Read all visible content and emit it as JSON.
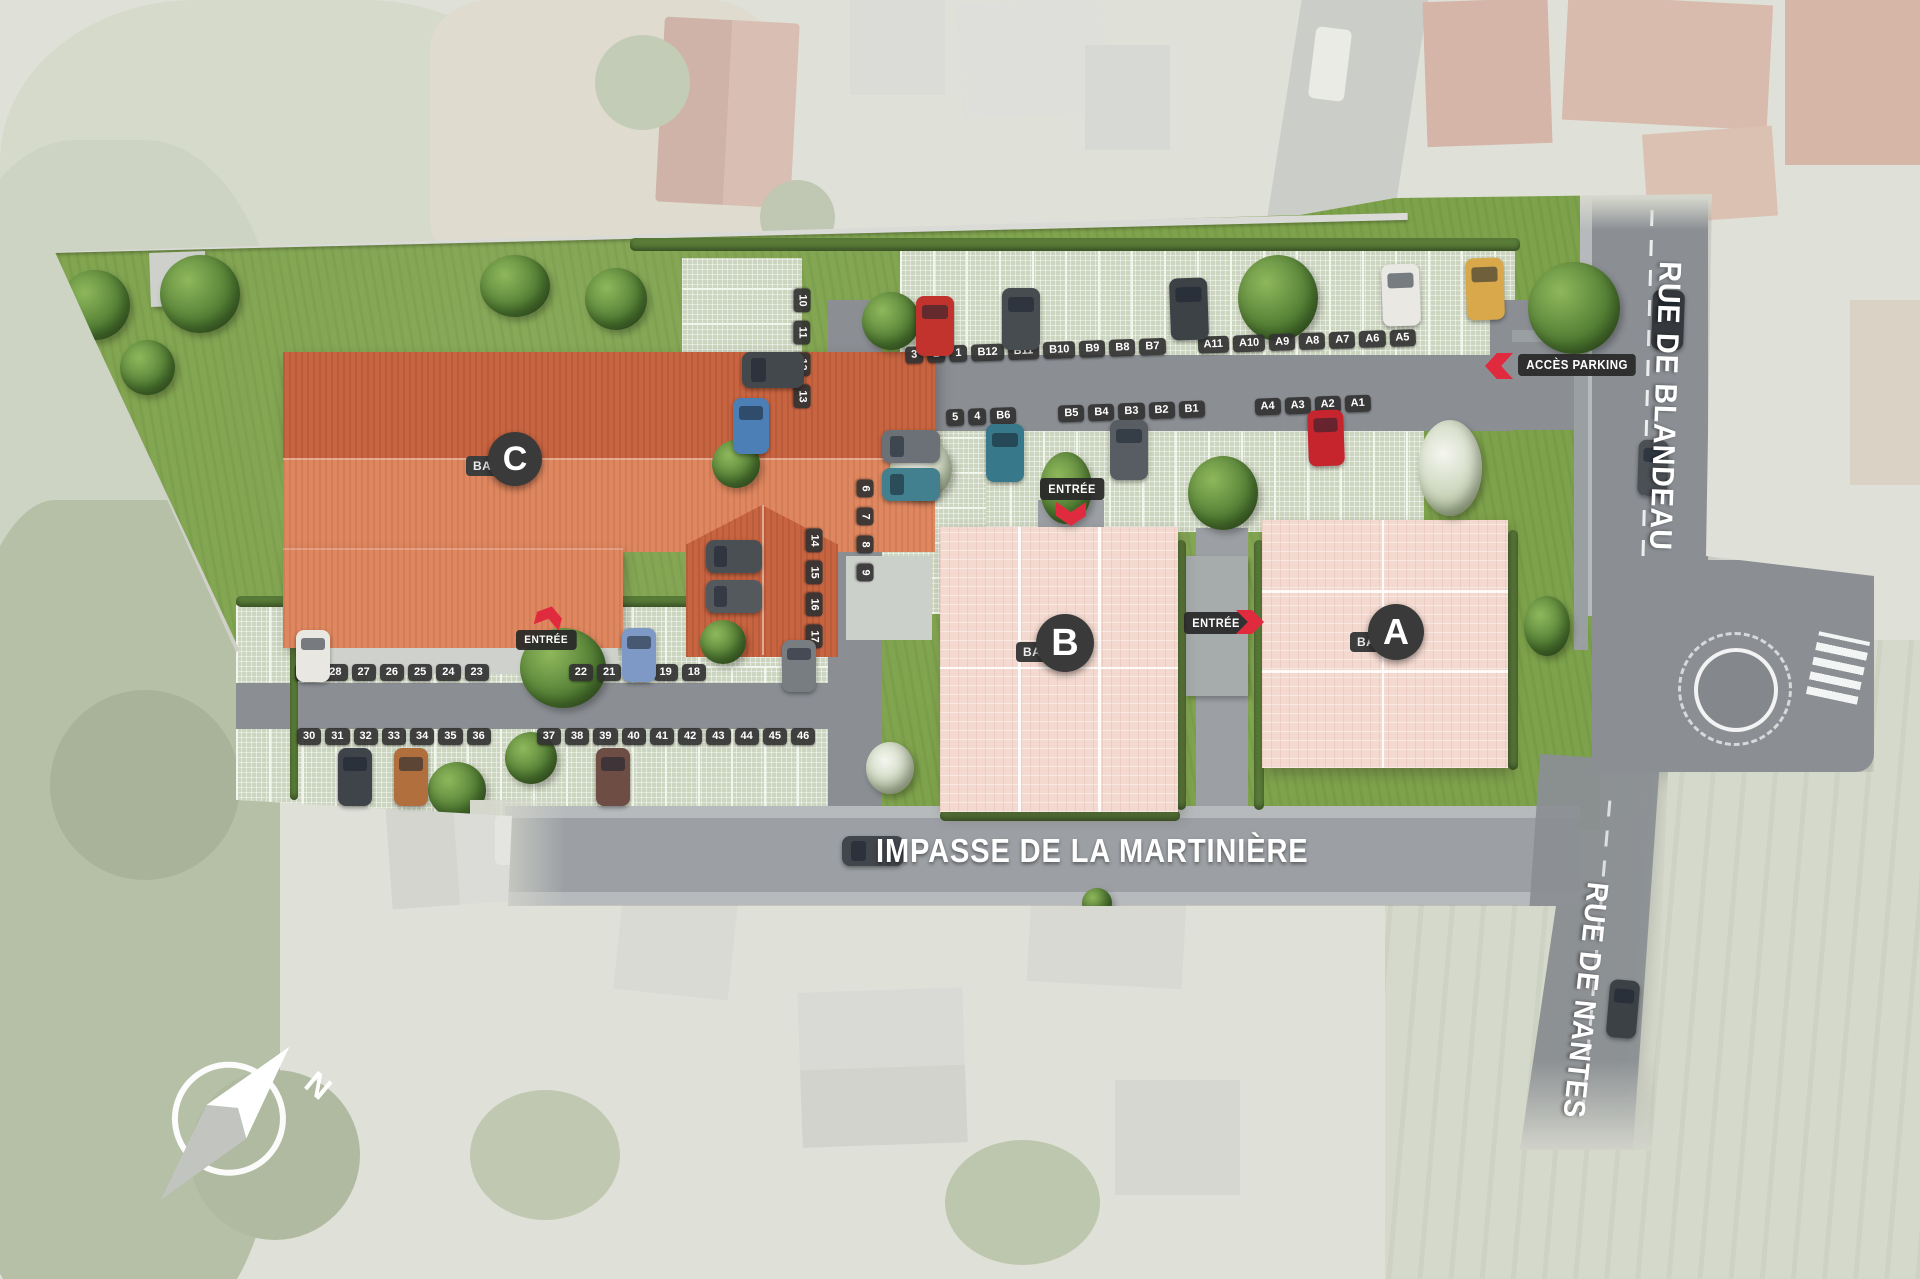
{
  "plan": {
    "title": "residence-site-plan",
    "streets": {
      "blandeau": "RUE DE BLANDEAU",
      "martiniere": "IMPASSE DE LA MARTINIÈRE",
      "nantes": "RUE DE NANTES"
    },
    "buildings": [
      {
        "id": "A",
        "prefix": "BAT.",
        "letter": "A"
      },
      {
        "id": "B",
        "prefix": "BAT.",
        "letter": "B"
      },
      {
        "id": "C",
        "prefix": "BAT.",
        "letter": "C"
      }
    ],
    "labels": {
      "entree": "ENTRÉE",
      "acces_parking": "ACCÈS PARKING"
    },
    "compass": {
      "north": "N"
    },
    "parking": {
      "north_row_1": [
        "3",
        "2",
        "1",
        "B12",
        "B11",
        "B10",
        "B9",
        "B8",
        "B7",
        "A11",
        "A10",
        "A9",
        "A8",
        "A7",
        "A6",
        "A5"
      ],
      "north_row_2": [
        "5",
        "4",
        "B6",
        "B5",
        "B4",
        "B3",
        "B2",
        "B1",
        "A4",
        "A3",
        "A2",
        "A1"
      ],
      "lane_left_upper": [
        "10",
        "11",
        "12",
        "13"
      ],
      "lane_left_lower": [
        "14",
        "15",
        "16",
        "17"
      ],
      "lane_right": [
        "6",
        "7",
        "8",
        "9"
      ],
      "west_row_top": [
        "29",
        "28",
        "27",
        "26",
        "25",
        "24",
        "23",
        "22",
        "21",
        "20",
        "19",
        "18"
      ],
      "west_row_bottom": [
        "30",
        "31",
        "32",
        "33",
        "34",
        "35",
        "36",
        "37",
        "38",
        "39",
        "40",
        "41",
        "42",
        "43",
        "44",
        "45",
        "46"
      ]
    },
    "colors": {
      "roof_dark": "#c96440",
      "roof_light": "#e0875f",
      "building_pink": "#f3d9cf",
      "accent_red": "#e02b3e",
      "label_bg": "#3a3a3a"
    }
  }
}
